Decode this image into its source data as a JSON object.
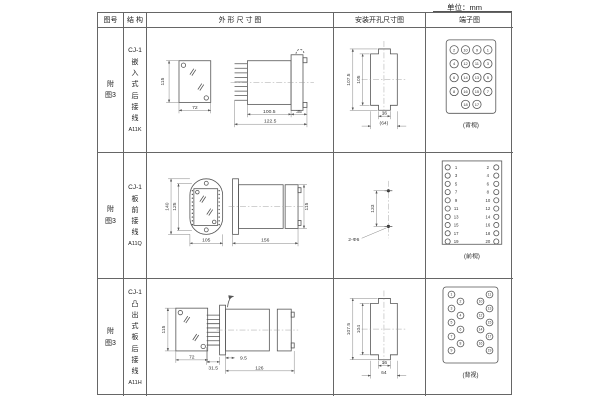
{
  "unit_label": "单位：mm",
  "table": {
    "headers": {
      "fig": "图号",
      "structure": "结 构",
      "outline": "外 形 尺 寸 图",
      "cutout": "安装开孔尺寸图",
      "terminal": "端子图"
    },
    "rows": [
      {
        "fig": "附图3",
        "model": "CJ-1",
        "type": "嵌入式后接线",
        "code": "A11K",
        "dims": {
          "h": "115",
          "w": "72",
          "body": "100.5",
          "total": "122.5",
          "flange": "35"
        },
        "cutout": {
          "outer": "107.5",
          "inner": "105",
          "slot": "16",
          "width": "(64)"
        },
        "terminal": {
          "view": "(背视)",
          "n": [
            "2",
            "10",
            "9",
            "1",
            "4",
            "12",
            "11",
            "3",
            "6",
            "14",
            "13",
            "5",
            "8",
            "16",
            "15",
            "7",
            "18",
            "17"
          ]
        }
      },
      {
        "fig": "附图3",
        "model": "CJ-1",
        "type": "板前接线",
        "code": "A11Q",
        "dims": {
          "outer": "140",
          "inner": "125",
          "w": "105",
          "len": "156",
          "h": "115"
        },
        "cutout": {
          "dist": "133",
          "holes": "2-Φ6"
        },
        "terminal": {
          "view": "(前视)",
          "n": [
            "1",
            "2",
            "3",
            "4",
            "5",
            "6",
            "7",
            "8",
            "9",
            "10",
            "11",
            "12",
            "13",
            "14",
            "15",
            "16",
            "17",
            "18",
            "19",
            "20"
          ]
        }
      },
      {
        "fig": "附图3",
        "model": "CJ-1",
        "type": "凸出式板后接线",
        "code": "A11H",
        "dims": {
          "h": "115",
          "w": "72",
          "offset": "31.5",
          "gap": "9.5",
          "len": "126"
        },
        "cutout": {
          "outer": "107.5",
          "inner": "104",
          "slot": "16",
          "width": "64"
        },
        "terminal": {
          "view": "(背视)",
          "n": [
            "1",
            "3",
            "5",
            "7",
            "9",
            "2",
            "4",
            "6",
            "8",
            "10",
            "12",
            "14",
            "16",
            "11",
            "13",
            "15",
            "17",
            "19"
          ]
        }
      }
    ]
  }
}
